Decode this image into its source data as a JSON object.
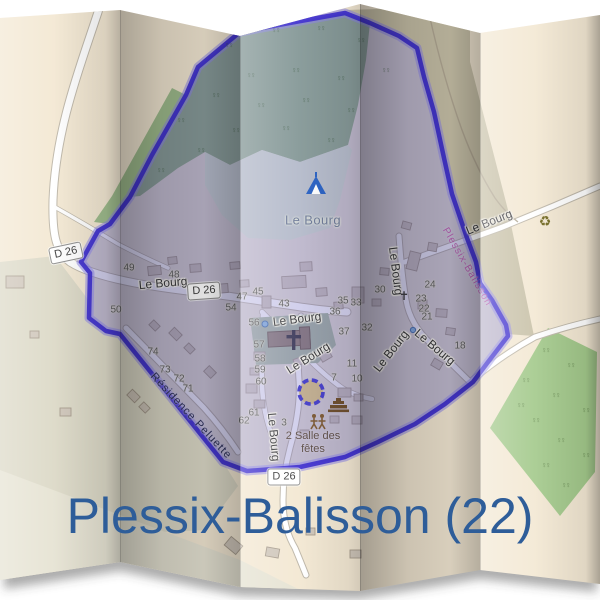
{
  "title": {
    "text": "Plessix-Balisson (22)",
    "color": "#2e5d99"
  },
  "map": {
    "place_label": {
      "text": "Le Bourg",
      "x": 313,
      "y": 220
    },
    "street_labels": [
      {
        "text": "Le Bourg",
        "x": 163,
        "y": 283,
        "rot": -5
      },
      {
        "text": "Le Bourg",
        "x": 297,
        "y": 319,
        "rot": -7
      },
      {
        "text": "Le Bourg",
        "x": 308,
        "y": 358,
        "rot": -32
      },
      {
        "text": "Le Bourg",
        "x": 396,
        "y": 271,
        "rot": 83
      },
      {
        "text": "Le Bourg",
        "x": 435,
        "y": 347,
        "rot": 40
      },
      {
        "text": "Le Bourg",
        "x": 391,
        "y": 351,
        "rot": -52
      },
      {
        "text": "Le Bourg",
        "x": 274,
        "y": 437,
        "rot": 85
      },
      {
        "text": "Le Bourg",
        "x": 489,
        "y": 222,
        "rot": -22
      }
    ],
    "residence_label": {
      "text": "Résidence Peluette",
      "x": 191,
      "y": 416,
      "rot": 47
    },
    "boundary_label": {
      "text": "Plessix-Balisson",
      "x": 467,
      "y": 267,
      "rot": 60,
      "color": "#b55fae"
    },
    "road_badges": [
      {
        "label": "D 26",
        "x": 66,
        "y": 253,
        "rot": -12
      },
      {
        "label": "D 26",
        "x": 204,
        "y": 291,
        "rot": -4
      },
      {
        "label": "D 26",
        "x": 284,
        "y": 477,
        "rot": 0
      }
    ],
    "house_numbers": [
      {
        "t": "49",
        "x": 129,
        "y": 268
      },
      {
        "t": "48",
        "x": 174,
        "y": 275
      },
      {
        "t": "50",
        "x": 116,
        "y": 310
      },
      {
        "t": "74",
        "x": 153,
        "y": 352
      },
      {
        "t": "73",
        "x": 165,
        "y": 370
      },
      {
        "t": "72",
        "x": 179,
        "y": 379
      },
      {
        "t": "71",
        "x": 188,
        "y": 389
      },
      {
        "t": "54",
        "x": 231,
        "y": 308
      },
      {
        "t": "47",
        "x": 242,
        "y": 297
      },
      {
        "t": "45",
        "x": 258,
        "y": 292
      },
      {
        "t": "43",
        "x": 284,
        "y": 304
      },
      {
        "t": "56",
        "x": 254,
        "y": 323
      },
      {
        "t": "57",
        "x": 259,
        "y": 345
      },
      {
        "t": "58",
        "x": 260,
        "y": 359
      },
      {
        "t": "59",
        "x": 260,
        "y": 370
      },
      {
        "t": "60",
        "x": 261,
        "y": 382
      },
      {
        "t": "61",
        "x": 254,
        "y": 413
      },
      {
        "t": "62",
        "x": 244,
        "y": 421
      },
      {
        "t": "3",
        "x": 284,
        "y": 423
      },
      {
        "t": "35",
        "x": 343,
        "y": 301
      },
      {
        "t": "33",
        "x": 356,
        "y": 303
      },
      {
        "t": "30",
        "x": 380,
        "y": 290
      },
      {
        "t": "36",
        "x": 335,
        "y": 312
      },
      {
        "t": "37",
        "x": 344,
        "y": 332
      },
      {
        "t": "32",
        "x": 367,
        "y": 328
      },
      {
        "t": "24",
        "x": 430,
        "y": 285
      },
      {
        "t": "23",
        "x": 421,
        "y": 299
      },
      {
        "t": "22",
        "x": 424,
        "y": 309
      },
      {
        "t": "21",
        "x": 427,
        "y": 317
      },
      {
        "t": "18",
        "x": 460,
        "y": 346
      },
      {
        "t": "11",
        "x": 352,
        "y": 364
      },
      {
        "t": "7",
        "x": 334,
        "y": 378
      },
      {
        "t": "10",
        "x": 357,
        "y": 379
      }
    ],
    "amenity_label": {
      "lines": [
        "2 Salle des",
        "fêtes"
      ],
      "x": 313,
      "y": 443
    },
    "glyph_icons": [
      {
        "name": "recycling-icon",
        "glyph": "♻",
        "x": 545,
        "y": 221,
        "size": 14,
        "color": "#6f661d"
      },
      {
        "name": "wayside-cross-icon",
        "glyph": "✝",
        "x": 404,
        "y": 296,
        "size": 12,
        "color": "#3f3f45"
      }
    ],
    "colors": {
      "boundary_stroke": "#3d2ecf",
      "boundary_fill": "rgba(98,92,190,0.30)",
      "paper_base": "#f3e8d3",
      "forest": "#95b489",
      "meadow": "#d9e4d2",
      "orchard": "#a3c98b"
    }
  }
}
